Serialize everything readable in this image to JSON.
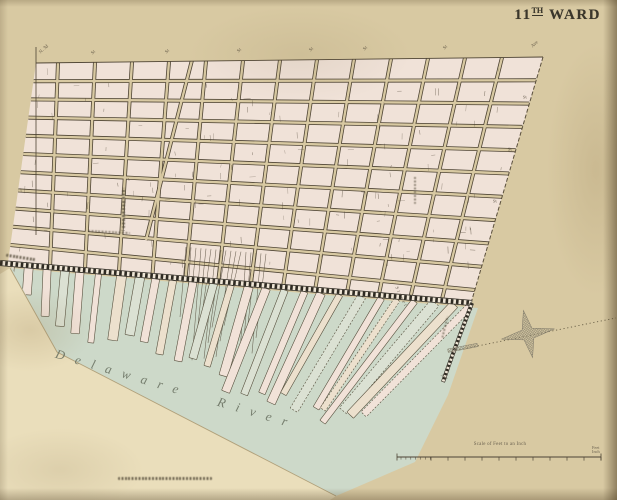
{
  "title": {
    "number": "11",
    "ordinal": "TH",
    "word": "WARD"
  },
  "map": {
    "river_label": "Delaware River",
    "top_edge_labels": [
      "N. 3d",
      "St",
      "St",
      "St",
      "St",
      "St",
      "St",
      "Ave"
    ],
    "right_edge_labels": [
      "St",
      "St",
      "St"
    ],
    "wharf_street_label": "Street",
    "wharf_ave_label": "Ave"
  },
  "scale_bar": {
    "caption": "Scale of Feet to an Inch",
    "right_top": "Feet",
    "right_bottom": "Inch"
  },
  "colors": {
    "paper": "#d8c9a2",
    "land": "#f0e2d8",
    "water": "#cdd9c9",
    "wedge": "#eadebb",
    "ink": "#4e4434",
    "boundary": "#5a4f3c",
    "track": "#2e2a22",
    "star": "#8d8773",
    "river_ink": "#6d7565",
    "title_ink": "#3a362b"
  }
}
